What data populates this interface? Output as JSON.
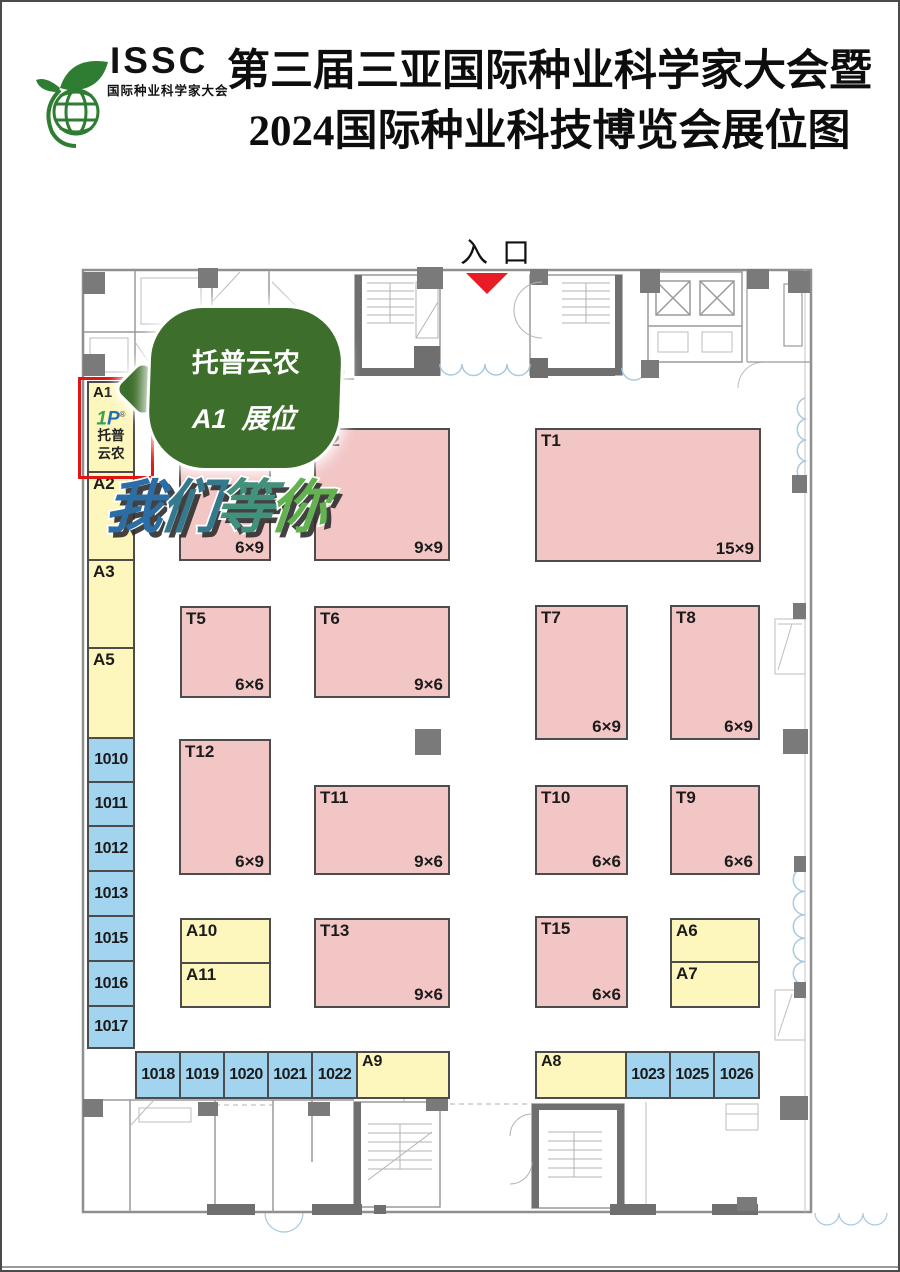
{
  "header": {
    "title_line1": "第三届三亚国际种业科学家大会暨",
    "title_line2": "2024国际种业科技博览会展位图",
    "logo_acronym": "ISSC",
    "logo_subtitle": "国际种业科学家大会"
  },
  "entrance": {
    "label": "入口"
  },
  "callout": {
    "line1": "托普云农",
    "line2": "A1  展位"
  },
  "banner": {
    "chars": [
      {
        "char": "我",
        "color": "#2b6ea6"
      },
      {
        "char": "们",
        "color": "#35798f"
      },
      {
        "char": "等",
        "color": "#41917c"
      },
      {
        "char": "你",
        "color": "#63b250"
      }
    ]
  },
  "plan_note": {
    "text": "T1"
  },
  "colors": {
    "booth_pink": "#f3c6c6",
    "booth_yellow": "#fdf6bd",
    "booth_blue": "#a2d4f0",
    "highlight_red": "#e01616",
    "callout_green": "#3d6e2b",
    "entrance_arrow_red": "#e81c24"
  },
  "booths": {
    "a1": {
      "id": "A1",
      "logo_mark_1": "1",
      "logo_mark_2": "P",
      "brand_line1": "托普",
      "brand_line2": "云农"
    },
    "a2": {
      "id": "A2"
    },
    "a3": {
      "id": "A3"
    },
    "a5": {
      "id": "A5"
    },
    "left_numbers": [
      "1010",
      "1011",
      "1012",
      "1013",
      "1015",
      "1016",
      "1017"
    ],
    "t_row1_unlabeled": {
      "id": "",
      "size": "6×9"
    },
    "t2": {
      "id": "T2",
      "size": "9×9"
    },
    "t1": {
      "id": "T1",
      "size": "15×9"
    },
    "t5": {
      "id": "T5",
      "size": "6×6"
    },
    "t6": {
      "id": "T6",
      "size": "9×6"
    },
    "t7": {
      "id": "T7",
      "size": "6×9"
    },
    "t8": {
      "id": "T8",
      "size": "6×9"
    },
    "t12": {
      "id": "T12",
      "size": "6×9"
    },
    "t11": {
      "id": "T11",
      "size": "9×6"
    },
    "t10": {
      "id": "T10",
      "size": "6×6"
    },
    "t9": {
      "id": "T9",
      "size": "6×6"
    },
    "t13": {
      "id": "T13",
      "size": "9×6"
    },
    "t15": {
      "id": "T15",
      "size": "6×6"
    },
    "a10": {
      "id": "A10"
    },
    "a11": {
      "id": "A11"
    },
    "a6": {
      "id": "A6"
    },
    "a7": {
      "id": "A7"
    },
    "a9": {
      "id": "A9"
    },
    "a8": {
      "id": "A8"
    },
    "bottom_left_numbers": [
      "1018",
      "1019",
      "1020",
      "1021",
      "1022"
    ],
    "bottom_right_numbers": [
      "1023",
      "1025",
      "1026"
    ]
  }
}
